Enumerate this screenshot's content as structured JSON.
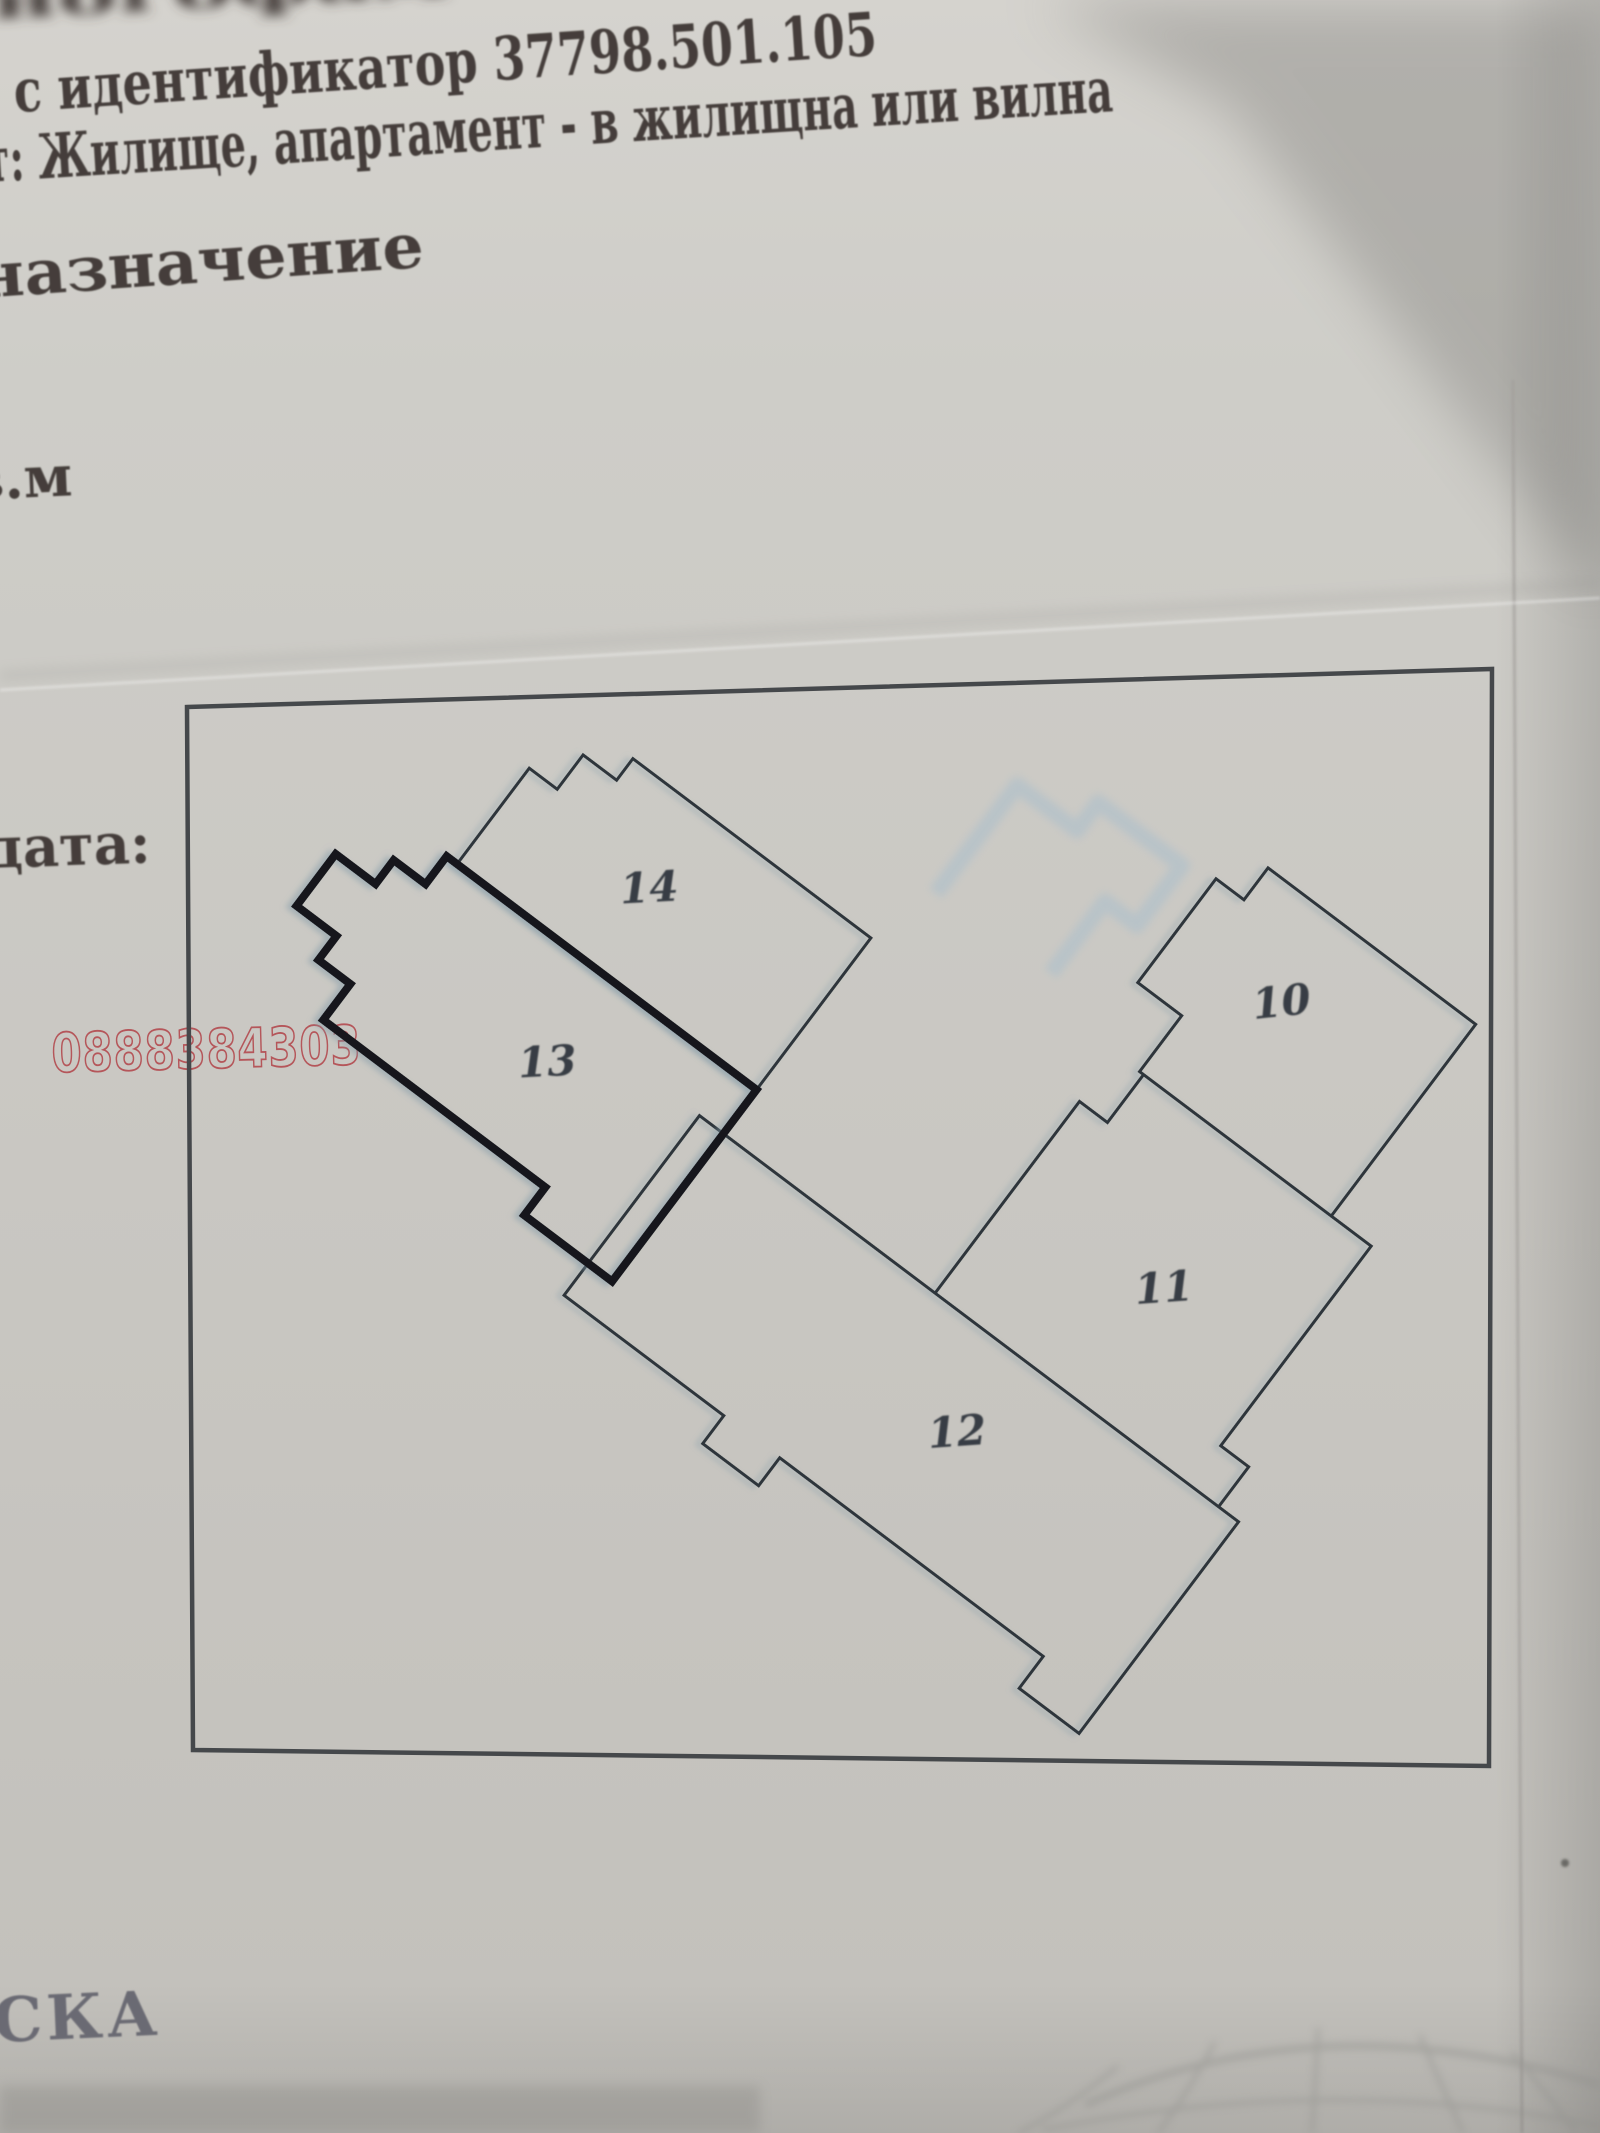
{
  "document": {
    "top_line_fragment": "ногофам",
    "identifier_line": "с идентификатор 37798.501.105",
    "type_line": "т: Жилище, апартамент - в жилищна или вилна",
    "purpose_line": "назначение",
    "unit_measure_fragment": "в.м",
    "date_label": "дата:",
    "footer_fragment": "СКА"
  },
  "watermark": {
    "phone": "0888384303"
  },
  "plan": {
    "units": [
      {
        "label": "14"
      },
      {
        "label": "13"
      },
      {
        "label": "10"
      },
      {
        "label": "11"
      },
      {
        "label": "12"
      }
    ]
  },
  "colors": {
    "paper": "#cbc9c4",
    "ink": "#443e3a",
    "wall": "#2f353a",
    "wall_bold": "#17191b",
    "ghost": "#b6c2c9",
    "watermark_red": "#b5565a",
    "footer_ink": "#6b6b73",
    "border": "#45484b"
  }
}
